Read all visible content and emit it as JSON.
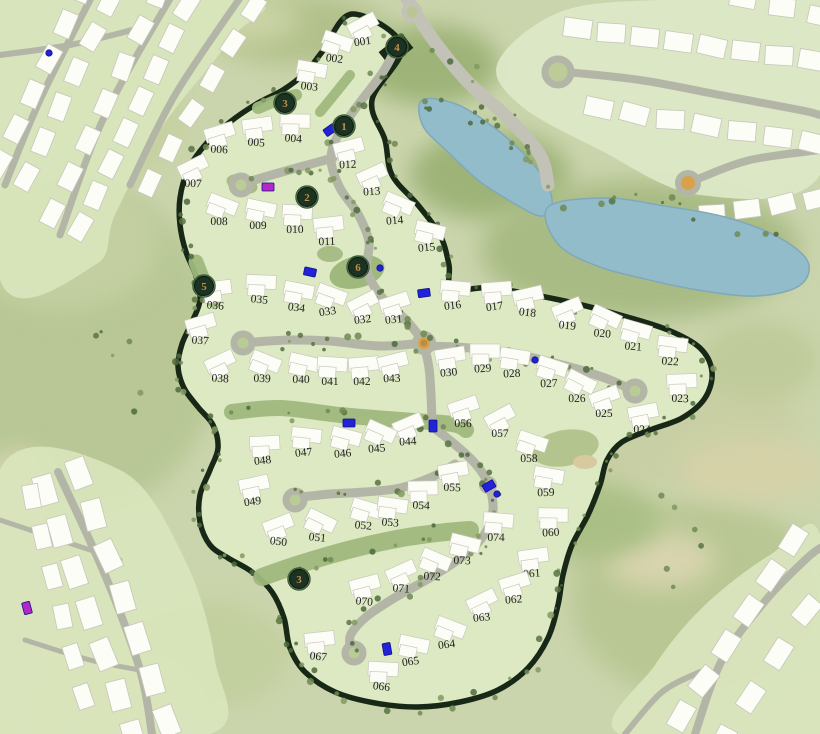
{
  "map": {
    "kind": "residential-masterplan-site-plan",
    "description": "Gated villa community plot map surrounded by golf course, lakes and neighbouring clusters"
  },
  "colors": {
    "background": "#cbd5ad",
    "site_fill": "#dce9c2",
    "site_boundary": "#172816",
    "road": "#b3b6a6",
    "building": "#fdfdf8",
    "lake": "#93bccb",
    "landscape_strip": "#9fb87c",
    "roundabout_center": "#d9a24a",
    "marker_fill": "#1b3320",
    "marker_number": "#c08d4e",
    "amenity_blue": "#2222d8",
    "amenity_purple": "#b428c8",
    "lot_number_text": "#1d1d1d"
  },
  "lots": [
    {
      "id": "001",
      "x": 363,
      "y": 45
    },
    {
      "id": "002",
      "x": 334,
      "y": 62
    },
    {
      "id": "003",
      "x": 309,
      "y": 90
    },
    {
      "id": "004",
      "x": 293,
      "y": 142
    },
    {
      "id": "005",
      "x": 256,
      "y": 146
    },
    {
      "id": "006",
      "x": 219,
      "y": 153
    },
    {
      "id": "007",
      "x": 193,
      "y": 187
    },
    {
      "id": "008",
      "x": 219,
      "y": 225
    },
    {
      "id": "009",
      "x": 258,
      "y": 229
    },
    {
      "id": "010",
      "x": 295,
      "y": 233
    },
    {
      "id": "011",
      "x": 327,
      "y": 245
    },
    {
      "id": "012",
      "x": 348,
      "y": 168
    },
    {
      "id": "013",
      "x": 372,
      "y": 195
    },
    {
      "id": "014",
      "x": 395,
      "y": 224
    },
    {
      "id": "015",
      "x": 427,
      "y": 251
    },
    {
      "id": "016",
      "x": 453,
      "y": 309
    },
    {
      "id": "017",
      "x": 495,
      "y": 310
    },
    {
      "id": "018",
      "x": 527,
      "y": 316
    },
    {
      "id": "019",
      "x": 567,
      "y": 329
    },
    {
      "id": "020",
      "x": 602,
      "y": 337
    },
    {
      "id": "021",
      "x": 633,
      "y": 350
    },
    {
      "id": "022",
      "x": 670,
      "y": 365
    },
    {
      "id": "023",
      "x": 680,
      "y": 402
    },
    {
      "id": "024",
      "x": 642,
      "y": 433
    },
    {
      "id": "025",
      "x": 604,
      "y": 417
    },
    {
      "id": "026",
      "x": 577,
      "y": 402
    },
    {
      "id": "027",
      "x": 549,
      "y": 387
    },
    {
      "id": "028",
      "x": 512,
      "y": 377
    },
    {
      "id": "029",
      "x": 483,
      "y": 372
    },
    {
      "id": "030",
      "x": 449,
      "y": 376
    },
    {
      "id": "031",
      "x": 394,
      "y": 323
    },
    {
      "id": "032",
      "x": 363,
      "y": 323
    },
    {
      "id": "033",
      "x": 328,
      "y": 315
    },
    {
      "id": "034",
      "x": 296,
      "y": 311
    },
    {
      "id": "035",
      "x": 259,
      "y": 303
    },
    {
      "id": "036",
      "x": 215,
      "y": 309
    },
    {
      "id": "037",
      "x": 200,
      "y": 344
    },
    {
      "id": "038",
      "x": 220,
      "y": 382
    },
    {
      "id": "039",
      "x": 262,
      "y": 382
    },
    {
      "id": "040",
      "x": 301,
      "y": 383
    },
    {
      "id": "041",
      "x": 330,
      "y": 385
    },
    {
      "id": "042",
      "x": 362,
      "y": 385
    },
    {
      "id": "043",
      "x": 392,
      "y": 382
    },
    {
      "id": "044",
      "x": 408,
      "y": 445
    },
    {
      "id": "045",
      "x": 377,
      "y": 452
    },
    {
      "id": "046",
      "x": 343,
      "y": 457
    },
    {
      "id": "047",
      "x": 304,
      "y": 456
    },
    {
      "id": "048",
      "x": 263,
      "y": 464
    },
    {
      "id": "049",
      "x": 253,
      "y": 505
    },
    {
      "id": "050",
      "x": 278,
      "y": 545
    },
    {
      "id": "051",
      "x": 317,
      "y": 541
    },
    {
      "id": "052",
      "x": 363,
      "y": 529
    },
    {
      "id": "053",
      "x": 390,
      "y": 526
    },
    {
      "id": "054",
      "x": 421,
      "y": 509
    },
    {
      "id": "055",
      "x": 452,
      "y": 491
    },
    {
      "id": "056",
      "x": 463,
      "y": 427
    },
    {
      "id": "057",
      "x": 500,
      "y": 437
    },
    {
      "id": "058",
      "x": 529,
      "y": 462
    },
    {
      "id": "059",
      "x": 546,
      "y": 496
    },
    {
      "id": "060",
      "x": 551,
      "y": 536
    },
    {
      "id": "061",
      "x": 532,
      "y": 577
    },
    {
      "id": "062",
      "x": 514,
      "y": 603
    },
    {
      "id": "063",
      "x": 482,
      "y": 621
    },
    {
      "id": "064",
      "x": 447,
      "y": 648
    },
    {
      "id": "065",
      "x": 411,
      "y": 665
    },
    {
      "id": "066",
      "x": 381,
      "y": 690
    },
    {
      "id": "067",
      "x": 318,
      "y": 660
    },
    {
      "id": "070",
      "x": 364,
      "y": 605
    },
    {
      "id": "071",
      "x": 401,
      "y": 592
    },
    {
      "id": "072",
      "x": 432,
      "y": 580
    },
    {
      "id": "073",
      "x": 462,
      "y": 564
    },
    {
      "id": "074",
      "x": 496,
      "y": 541
    }
  ],
  "markers": [
    {
      "label": "4",
      "x": 397,
      "y": 47
    },
    {
      "label": "3",
      "x": 285,
      "y": 103
    },
    {
      "label": "1",
      "x": 344,
      "y": 126
    },
    {
      "label": "2",
      "x": 307,
      "y": 197
    },
    {
      "label": "5",
      "x": 204,
      "y": 286
    },
    {
      "label": "6",
      "x": 358,
      "y": 267
    },
    {
      "label": "3",
      "x": 299,
      "y": 579
    }
  ],
  "amenity_markers": [
    {
      "type": "blue",
      "x": 330,
      "y": 130,
      "rot": -35
    },
    {
      "type": "purple",
      "x": 268,
      "y": 187,
      "rot": 0
    },
    {
      "type": "blue",
      "x": 310,
      "y": 272,
      "rot": 12
    },
    {
      "type": "blue-dot",
      "x": 380,
      "y": 268,
      "rot": 0
    },
    {
      "type": "blue",
      "x": 424,
      "y": 293,
      "rot": -8
    },
    {
      "type": "blue-dot",
      "x": 535,
      "y": 360,
      "rot": 0
    },
    {
      "type": "blue",
      "x": 349,
      "y": 423,
      "rot": 0
    },
    {
      "type": "blue",
      "x": 433,
      "y": 426,
      "rot": 90
    },
    {
      "type": "blue",
      "x": 489,
      "y": 486,
      "rot": -30
    },
    {
      "type": "blue-dot",
      "x": 497,
      "y": 494,
      "rot": 0
    },
    {
      "type": "blue",
      "x": 387,
      "y": 649,
      "rot": 80
    },
    {
      "type": "blue-dot",
      "x": 49,
      "y": 53,
      "rot": 0
    },
    {
      "type": "purple",
      "x": 27,
      "y": 608,
      "rot": 75
    }
  ]
}
